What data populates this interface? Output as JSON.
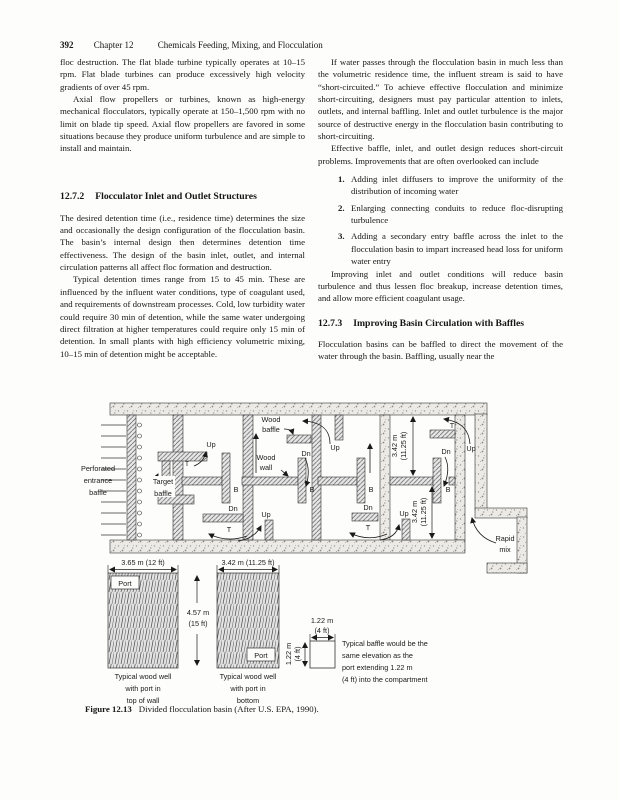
{
  "header": {
    "page_number": "392",
    "chapter": "Chapter 12",
    "title": "Chemicals Feeding, Mixing, and Flocculation"
  },
  "left_column": {
    "para1": "floc destruction. The flat blade turbine typically operates at 10–15 rpm. Flat blade turbines can produce excessively high velocity gradients of over 45 rpm.",
    "para2": "Axial flow propellers or turbines, known as high-energy mechanical flocculators, typically operate at 150–1,500 rpm with no limit on blade tip speed. Axial flow propellers are favored in some situations because they produce uniform turbulence and are simple to install and maintain.",
    "section": {
      "number": "12.7.2",
      "title": "Flocculator Inlet and Outlet Structures"
    },
    "para3": "The desired detention time (i.e., residence time) determines the size and occasionally the design configuration of the flocculation basin. The basin’s internal design then determines detention time effectiveness. The design of the basin inlet, outlet, and internal circulation patterns all affect floc formation and destruction.",
    "para4": "Typical detention times range from 15 to 45 min. These are influenced by the influent water conditions, type of coagulant used, and requirements of downstream processes. Cold, low turbidity water could require 30 min of detention, while the same water undergoing direct filtration at higher temperatures could require only 15 min of detention. In small plants with high efficiency volumetric mixing, 10–15 min of detention might be acceptable."
  },
  "right_column": {
    "para1": "If water passes through the flocculation basin in much less than the volumetric residence time, the influent stream is said to have “short-circuited.” To achieve effective flocculation and minimize short-circuiting, designers must pay particular attention to inlets, outlets, and internal baffling. Inlet and outlet turbulence is the major source of destructive energy in the flocculation basin contributing to short-circuiting.",
    "para2": "Effective baffle, inlet, and outlet design reduces short-circuit problems. Improvements that are often overlooked can include",
    "list": [
      {
        "num": "1.",
        "text": "Adding inlet diffusers to improve the uniformity of the distribution of incoming water"
      },
      {
        "num": "2.",
        "text": "Enlarging connecting conduits to reduce floc-disrupting turbulence"
      },
      {
        "num": "3.",
        "text": "Adding a secondary entry baffle across the inlet to the flocculation basin to impart increased head loss for uniform water entry"
      }
    ],
    "para3": "Improving inlet and outlet conditions will reduce basin turbulence and thus lessen floc breakup, increase detention times, and allow more efficient coagulant usage.",
    "section": {
      "number": "12.7.3",
      "title": "Improving Basin Circulation with Baffles"
    },
    "para4": "Flocculation basins can be baffled to direct the movement of the water through the basin. Baffling, usually near the"
  },
  "figure": {
    "labels": {
      "perforated_baffle": [
        "Perforated",
        "entrance",
        "baffle"
      ],
      "target_baffle": [
        "Target",
        "baffle"
      ],
      "wood_baffle": [
        "Wood",
        "baffle"
      ],
      "wood_wall": [
        "Wood",
        "wall"
      ],
      "rapid_mix": [
        "Rapid",
        "mix"
      ],
      "up": "Up",
      "dn": "Dn",
      "t": "T",
      "b": "B",
      "dim_342_rot": [
        "3.42 m",
        "(11.25 ft)"
      ],
      "dim_365": "3.65 m (12 ft)",
      "dim_342": "3.42 m (11.25 ft)",
      "dim_457": [
        "4.57 m",
        "(15 ft)"
      ],
      "dim_122": [
        "1.22 m",
        "(4 ft)"
      ],
      "port": "Port",
      "well_left_caption": [
        "Typical wood well",
        "with port in",
        "top of wall"
      ],
      "well_right_caption": [
        "Typical wood well",
        "with port in",
        "bottom"
      ],
      "baffle_note": [
        "Typical baffle would be the",
        "same elevation as the",
        "port extending 1.22 m",
        "(4 ft) into the compartment"
      ]
    },
    "caption": {
      "label": "Figure 12.13",
      "text": "Divided flocculation basin (After U.S. EPA, 1990)."
    }
  },
  "colors": {
    "page_bg": "#fdfdfb",
    "text": "#151515",
    "line": "#333333",
    "hatch_fill": "#e7e7e7",
    "concrete_fill": "#eceae6"
  }
}
